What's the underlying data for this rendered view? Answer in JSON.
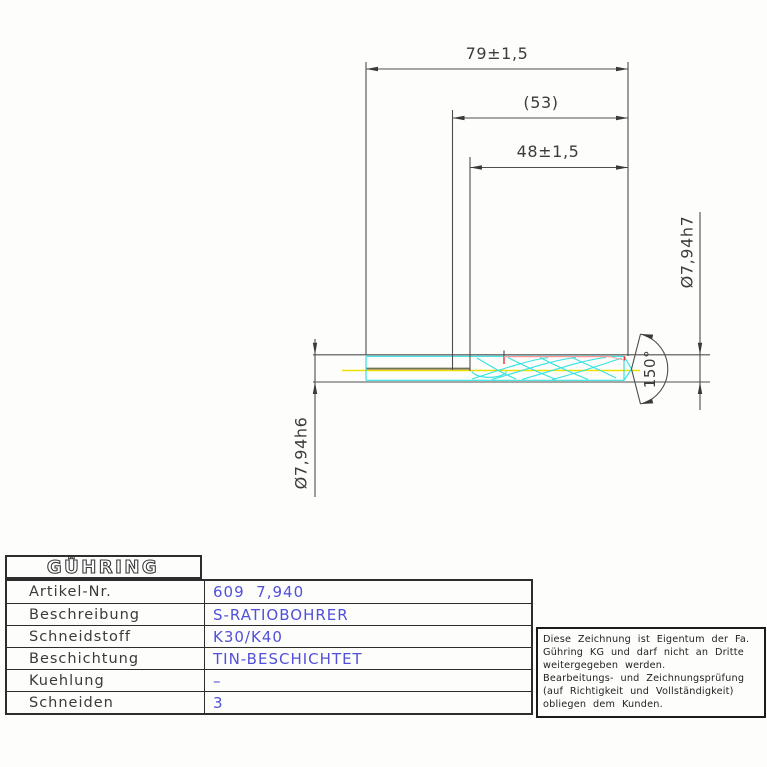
{
  "drawing": {
    "labels": {
      "overall_length": "79±1,5",
      "intermediate_length": "(53)",
      "flute_length": "48±1,5",
      "flute_diameter": "Ø7,94h7",
      "shank_diameter": "Ø7,94h6",
      "point_angle": "150°"
    },
    "colors": {
      "line_gray": "#4e4e4e",
      "flute_cyan": "#35e2e2",
      "centerline_yellow": "#efe000",
      "highlight_red": "#e03030",
      "shank_olive": "#73735c",
      "value_blue": "#5050d8"
    }
  },
  "infotable": {
    "logo": "GÜHRING",
    "rows": [
      {
        "label": "Artikel-Nr.",
        "value": "609  7,940"
      },
      {
        "label": "Beschreibung",
        "value": "S-RATIOBOHRER"
      },
      {
        "label": "Schneidstoff",
        "value": "K30/K40"
      },
      {
        "label": "Beschichtung",
        "value": "TIN-BESCHICHTET"
      },
      {
        "label": "Kuehlung",
        "value": "–"
      },
      {
        "label": "Schneiden",
        "value": "3"
      }
    ]
  },
  "notice": {
    "lines": [
      "Diese Zeichnung ist Eigentum der Fa.",
      "Gühring KG und darf nicht an Dritte",
      "weitergegeben werden.",
      "Bearbeitungs- und Zeichnungsprüfung",
      "(auf Richtigkeit und Vollständigkeit)",
      "obliegen dem Kunden."
    ]
  }
}
